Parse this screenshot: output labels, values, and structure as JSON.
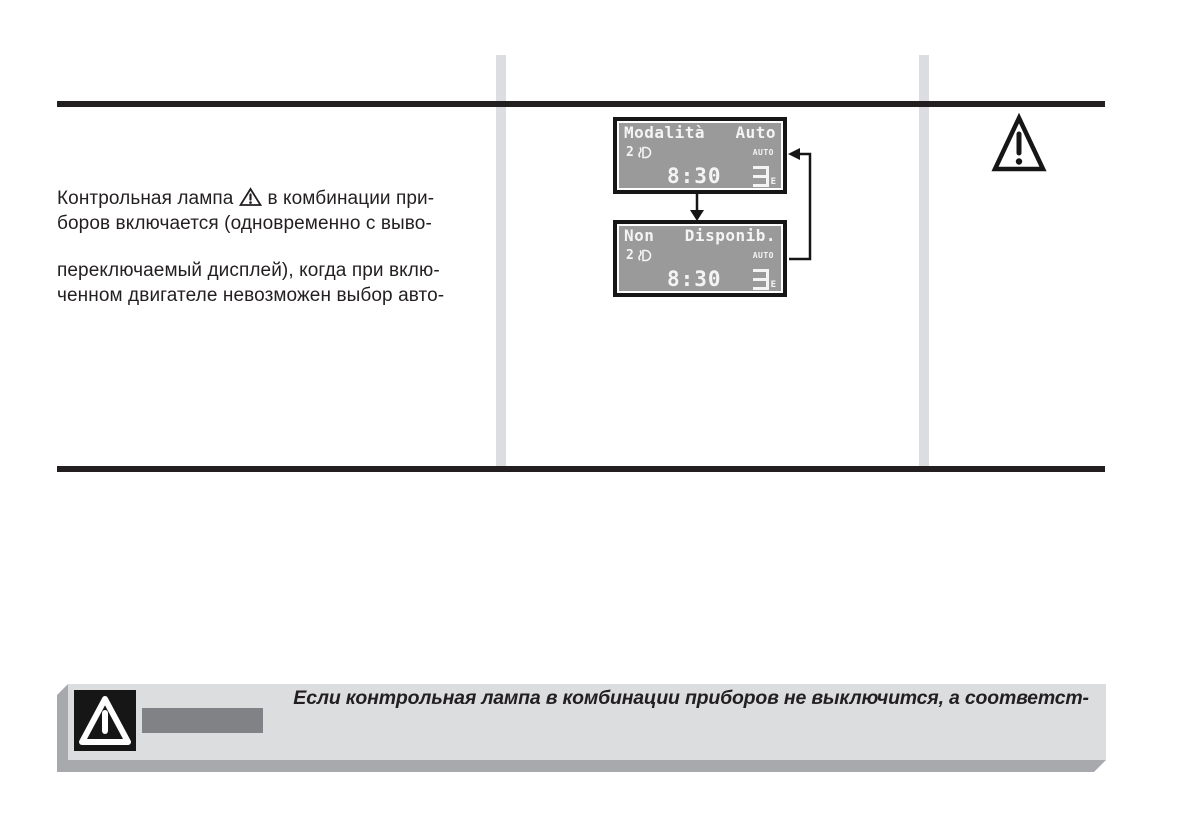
{
  "colors": {
    "rule": "#231f20",
    "text": "#231f20",
    "column_bar": "#dcdde0",
    "lcd_background": "#9a9a9a",
    "lcd_text": "#f4f4f4",
    "lcd_frame": "#161616",
    "warning_box_face": "#dcdddf",
    "warning_box_shadow": "#a7a9ac",
    "warning_label_bar": "#808285"
  },
  "paragraph": {
    "line1_before": "Контрольная лампа",
    "line1_after": "в комбинации при-",
    "line2": "боров включается (одновременно с выво-",
    "line3": "переключаемый дисплей), когда при вклю-",
    "line4": "ченном двигателе невозможен выбор авто-"
  },
  "displays": [
    {
      "title_left": "Modalità",
      "title_right": "Auto",
      "left_value": "2",
      "mode_label": "AUTO",
      "time": "8:30",
      "gear_digit": "3",
      "gear_suffix": "E"
    },
    {
      "title_left": "Non",
      "title_right": "Disponib.",
      "left_value": "2",
      "mode_label": "AUTO",
      "time": "8:30",
      "gear_digit": "3",
      "gear_suffix": "E"
    }
  ],
  "warning_box": {
    "text": "Если контрольная лампа в комбинации приборов не выключится, а соответст-"
  },
  "icons": {
    "inline_warning": "warning-triangle",
    "top_right_warning": "warning-triangle",
    "box_warning": "warning-triangle-inverse",
    "lcd_beam": "low-beam-headlight",
    "flow_down": "arrow-down",
    "flow_loop": "arrow-loop-left"
  }
}
